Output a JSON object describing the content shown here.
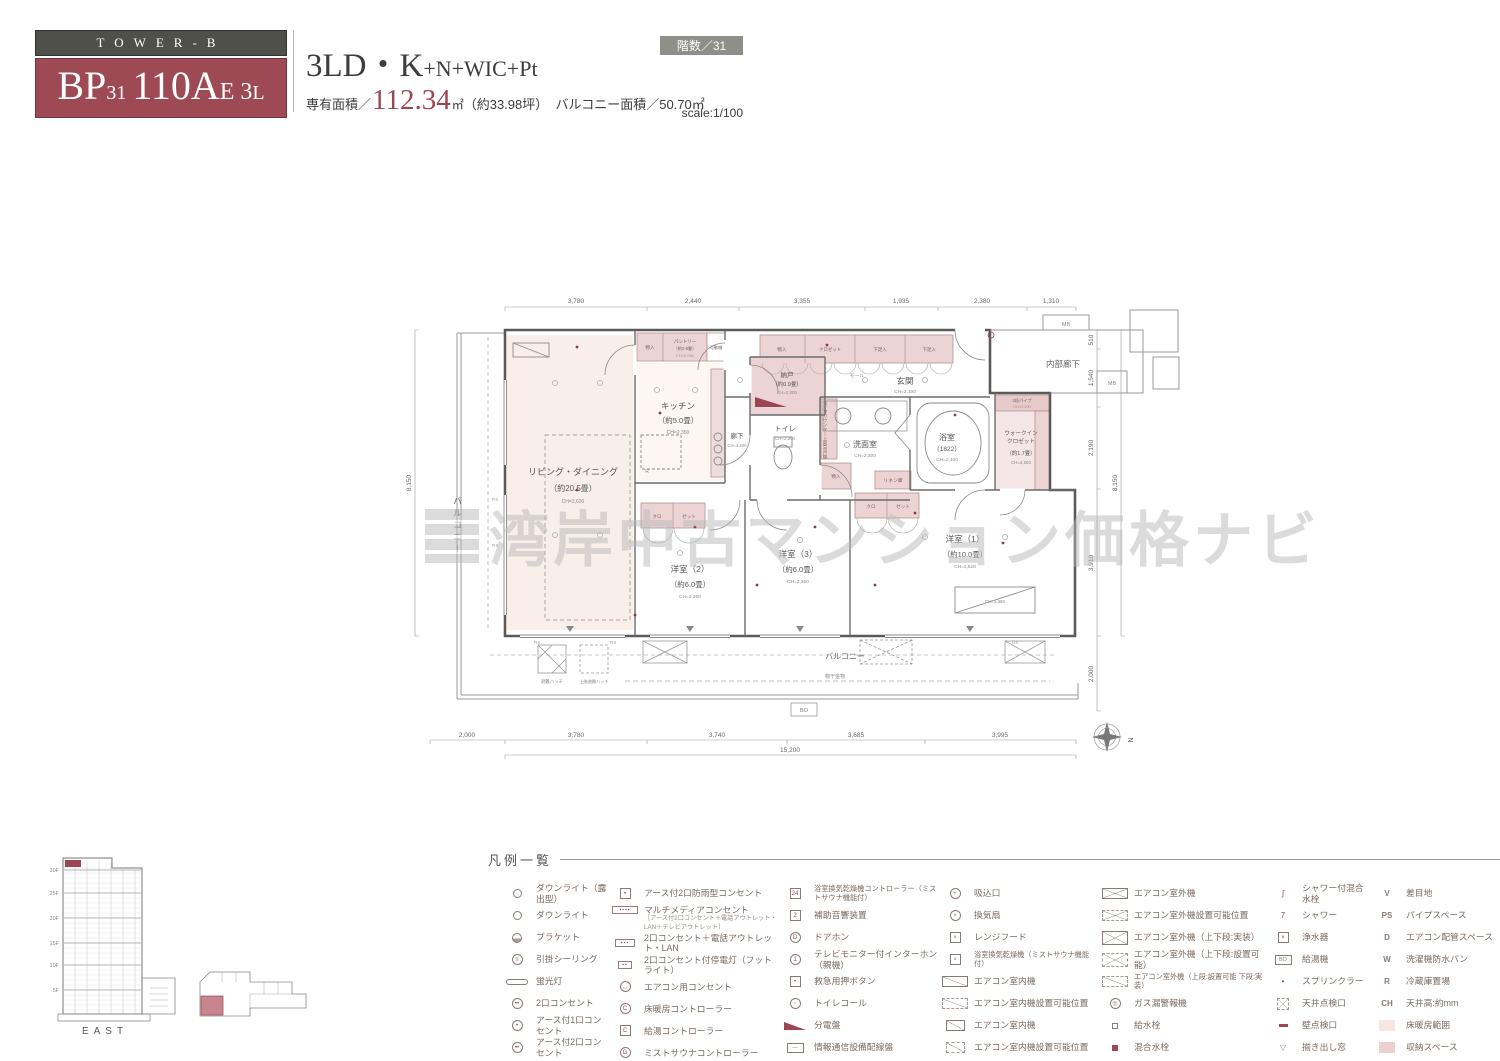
{
  "header": {
    "tower": "TOWER-B",
    "unit": {
      "p1": "BP",
      "p1s": "31",
      "p2": "110A",
      "p2s": "E",
      "p3": "3",
      "p3s": "L"
    },
    "type_main": "3LD・K",
    "type_sub": "+N+WIC+Pt",
    "area_label": "専有面積／",
    "area_value": "112.34",
    "area_unit": "㎡",
    "area_tsubo": "（約33.98坪）",
    "balcony_area": "バルコニー面積／50.70㎡",
    "floor_badge": "階数／31",
    "scale": "scale:1/100"
  },
  "watermark": {
    "text": "湾岸中古マンション価格ナビ"
  },
  "plan": {
    "rooms": {
      "living": {
        "name": "リビング・ダイニング",
        "size": "（約20.5畳）",
        "ch": "CH=2,620"
      },
      "kitchen": {
        "name": "キッチン",
        "size": "（約5.0畳）",
        "ch": "CH=2,350"
      },
      "pantry": {
        "name": "パントリー",
        "size": "（約0.8畳）",
        "ch": "CH=2,050"
      },
      "entrance": {
        "name": "玄関",
        "ch": "CH=2,100"
      },
      "corridor": "内部廊下",
      "nando": {
        "name": "納戸",
        "size": "（約0.9畳）",
        "ch": "CH=2,200"
      },
      "hall": {
        "name": "廊下",
        "ch": "CH=2,200"
      },
      "toilet": {
        "name": "トイレ",
        "ch": "CH=2,200"
      },
      "wash": {
        "name": "洗面室",
        "ch": "CH=2,200"
      },
      "bath": {
        "name": "浴室",
        "size": "（1822）",
        "ch": "CH=2,100"
      },
      "wic": {
        "l1": "ウォークイン",
        "l2": "クロゼット",
        "size": "（約1.7畳）",
        "ch": "CH=2,500"
      },
      "bed1": {
        "name": "洋室（1）",
        "size": "（約10.0畳）",
        "ch": "CH=2,620"
      },
      "bed2": {
        "name": "洋室（2）",
        "size": "（約6.0畳）",
        "ch": "CH=2,350"
      },
      "bed3": {
        "name": "洋室（3）",
        "size": "（約6.0畳）",
        "ch": "CH=2,350"
      }
    },
    "labels": {
      "balcony": "バルコニー",
      "monohoshi": "物干金物",
      "hatch1": "避難ハッチ",
      "hatch2": "上階避難ハッチ",
      "monoire": "物入",
      "closet": "クロゼット",
      "shoe": "下足入",
      "kadoudana": "可動棚",
      "mall": "モール",
      "mb": "MB",
      "fix": "FIX",
      "bo": "BO",
      "north": "N",
      "linen": "リネン庫",
      "pipe": "2段パイプ",
      "pipe_ch": "CH=2,200",
      "kuro": "クロ",
      "zetto": "ゼット",
      "wd": "W／Dカウンター上部吊戸棚",
      "ac_ch": "CH=2,380",
      "r": "R"
    },
    "dims": {
      "top": [
        "3,780",
        "2,440",
        "3,355",
        "1,935",
        "2,380",
        "1,310"
      ],
      "bottom": [
        "2,000",
        "3,780",
        "3,740",
        "3,685",
        "3,995"
      ],
      "bottom_total": "15,200",
      "left": "8,150",
      "right": [
        "510",
        "1,540",
        "2,190",
        "3,910",
        "2,000"
      ],
      "right_total": "8,150"
    }
  },
  "elevation": {
    "floors": [
      "30F",
      "25F",
      "20F",
      "15F",
      "10F",
      "5F"
    ],
    "direction": "EAST"
  },
  "legend": {
    "title": "凡例一覧",
    "columns": [
      {
        "items": [
          {
            "sym": "dlx gray",
            "label": "ダウンライト（露出型）"
          },
          {
            "sym": "dl gray",
            "label": "ダウンライト"
          },
          {
            "sym": "bracket gray",
            "label": "ブラケット"
          },
          {
            "sym": "circ gray",
            "symtext": "≡",
            "label": "引掛シーリング"
          },
          {
            "sym": "fluor gray",
            "label": "蛍光灯"
          },
          {
            "sym": "circ red",
            "symtext": "••",
            "label": "2口コンセント"
          },
          {
            "sym": "circ red",
            "symtext": "•",
            "label": "アース付1口コンセント"
          },
          {
            "sym": "circ red",
            "symtext": "••",
            "label": "アース付2口コンセント"
          }
        ]
      },
      {
        "items": [
          {
            "sym": "box red",
            "symtext": "•",
            "label": "アース付2口防雨型コンセント"
          },
          {
            "sym": "multi4 red",
            "symtext": "▪▪▪▪",
            "label": "マルチメディアコンセント",
            "sub": "［アース付2口コンセント＋電話アウトレット・LAN＋テレビアウトレット］"
          },
          {
            "sym": "multi3 red",
            "symtext": "▪▪▪",
            "label": "2口コンセント＋電話アウトレット・LAN"
          },
          {
            "sym": "multi2 red",
            "symtext": "▪▪",
            "label": "2口コンセント付停電灯（フットライト）"
          },
          {
            "sym": "circ red",
            "symtext": "◡",
            "label": "エアコン用コンセント"
          },
          {
            "sym": "circ red",
            "symtext": "C",
            "label": "床暖房コントローラー"
          },
          {
            "sym": "box red",
            "symtext": "C",
            "label": "給湯コントローラー"
          },
          {
            "sym": "circ red",
            "symtext": "G",
            "label": "ミストサウナコントローラー"
          }
        ]
      },
      {
        "items": [
          {
            "sym": "box red",
            "symtext": "24",
            "label": "浴室換気乾燥機コントローラー（ミストサウナ機能付）",
            "small": true
          },
          {
            "sym": "box red",
            "symtext": "2",
            "label": "補助音響装置"
          },
          {
            "sym": "circ red",
            "symtext": "D",
            "label": "ドアホン"
          },
          {
            "sym": "circ red",
            "symtext": "1",
            "label": "テレビモニター付インターホン（親機）"
          },
          {
            "sym": "box red",
            "symtext": "•",
            "label": "救急用押ボタン"
          },
          {
            "sym": "circ red",
            "symtext": "◦",
            "label": "トイレコール"
          },
          {
            "sym": "wedge",
            "label": "分電盤"
          },
          {
            "sym": "boxw gray",
            "symtext": "—",
            "label": "情報通信設備配線盤"
          }
        ]
      },
      {
        "items": [
          {
            "sym": "circ gray",
            "symtext": "+",
            "label": "吸込口"
          },
          {
            "sym": "circ gray",
            "symtext": "×",
            "label": "換気扇"
          },
          {
            "sym": "box gray",
            "symtext": "×",
            "label": "レンジフード"
          },
          {
            "sym": "box gray",
            "symtext": "×",
            "label": "浴室換気乾燥機（ミストサウナ機能付）",
            "small": true
          },
          {
            "sym": "diagbox diag",
            "label": "エアコン室内機"
          },
          {
            "sym": "diagboxd diag",
            "label": "エアコン室内機設置可能位置"
          },
          {
            "sym": "diagbox2 diag",
            "label": "エアコン室内機"
          },
          {
            "sym": "diagbox2d diag",
            "label": "エアコン室内機設置可能位置"
          }
        ]
      },
      {
        "items": [
          {
            "sym": "diagbox xed",
            "label": "エアコン室外機"
          },
          {
            "sym": "diagboxd xed",
            "label": "エアコン室外機設置可能位置"
          },
          {
            "sym": "diagbox xed tall",
            "label": "エアコン室外機（上下段:実装）"
          },
          {
            "sym": "diagboxd xed tall",
            "label": "エアコン室外機（上下段:設置可能）"
          },
          {
            "sym": "diagboxd diag",
            "label": "エアコン室外機（上段:設置可能 下段:実装）",
            "small": true
          },
          {
            "sym": "circ gray",
            "symtext": "◎",
            "label": "ガス漏警報機"
          },
          {
            "sym": "sqs",
            "label": "給水栓"
          },
          {
            "sym": "sqf",
            "label": "混合水栓"
          }
        ]
      },
      {
        "items": [
          {
            "sym": "plain red",
            "symtext": "ʃ",
            "label": "シャワー付混合水栓"
          },
          {
            "sym": "plain red",
            "symtext": "7",
            "label": "シャワー"
          },
          {
            "sym": "box red",
            "symtext": "×",
            "label": "浄水器"
          },
          {
            "sym": "boxw gray",
            "symtext": "BO",
            "label": "給湯機"
          },
          {
            "sym": "plain red",
            "symtext": "•",
            "label": "スプリンクラー"
          },
          {
            "sym": "ceilins xed",
            "label": "天井点検口"
          },
          {
            "sym": "bar",
            "label": "壁点検口"
          },
          {
            "sym": "plain gray",
            "symtext": "▽",
            "label": "揃き出し窓"
          }
        ]
      },
      {
        "items": [
          {
            "sym": "ltr",
            "symtext": "V",
            "label": "差目地"
          },
          {
            "sym": "ltr",
            "symtext": "PS",
            "label": "パイプスペース"
          },
          {
            "sym": "ltr",
            "symtext": "D",
            "label": "エアコン配管スペース"
          },
          {
            "sym": "ltr",
            "symtext": "W",
            "label": "洗濯機防水パン"
          },
          {
            "sym": "ltr",
            "symtext": "R",
            "label": "冷蔵庫置場"
          },
          {
            "sym": "ltr",
            "symtext": "CH",
            "label": "天井高:約mm"
          },
          {
            "sym": "swb",
            "label": "床暖房範囲"
          },
          {
            "sym": "swp",
            "label": "収納スペース"
          }
        ]
      }
    ]
  }
}
